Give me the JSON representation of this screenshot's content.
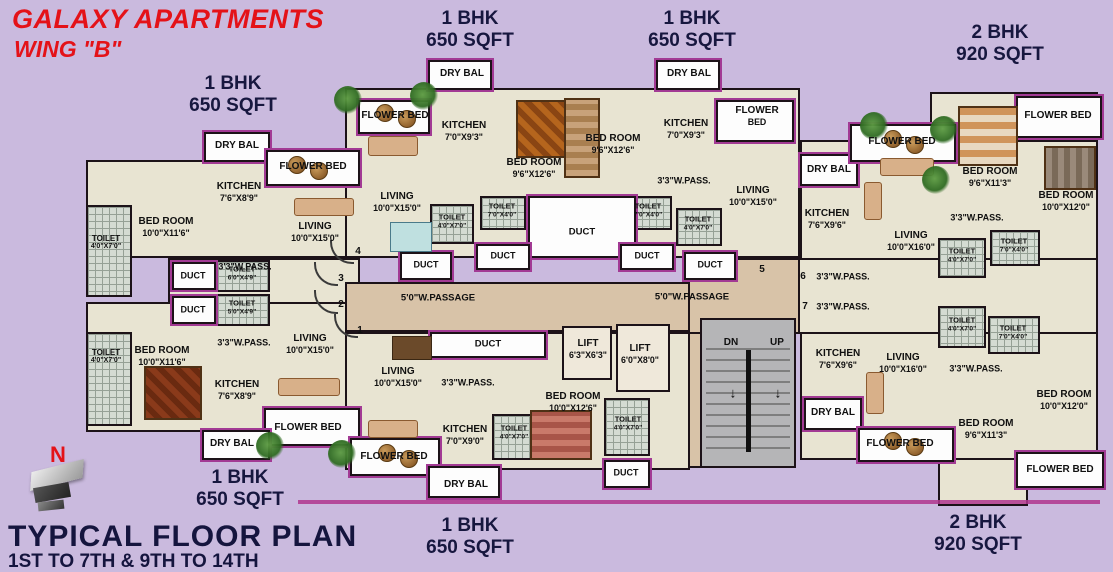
{
  "header": {
    "title": "GALAXY APARTMENTS",
    "wing": "WING \"B\""
  },
  "footer": {
    "north": "N",
    "plan_title": "TYPICAL FLOOR PLAN",
    "floors_range": "1ST TO 7TH & 9TH TO 14TH"
  },
  "colors": {
    "background": "#cabade",
    "room_fill": "#e8e4d2",
    "wall": "#1c1218",
    "balcony_trim": "#a23a94",
    "passage": "#d8c3a8",
    "stair": "#b5b5b7",
    "title_red": "#e41218",
    "navy": "#17173f"
  },
  "unit_labels": [
    {
      "n": "unit-label-1bhk-top-left",
      "l1": "1 BHK",
      "l2": "650 SQFT",
      "x": 233,
      "y": 95
    },
    {
      "n": "unit-label-1bhk-top-center",
      "l1": "1 BHK",
      "l2": "650 SQFT",
      "x": 470,
      "y": 30
    },
    {
      "n": "unit-label-1bhk-top-right",
      "l1": "1 BHK",
      "l2": "650 SQFT",
      "x": 692,
      "y": 30
    },
    {
      "n": "unit-label-2bhk-top-right",
      "l1": "2 BHK",
      "l2": "920 SQFT",
      "x": 1000,
      "y": 44
    },
    {
      "n": "unit-label-1bhk-bottom-left",
      "l1": "1 BHK",
      "l2": "650 SQFT",
      "x": 240,
      "y": 489
    },
    {
      "n": "unit-label-1bhk-bottom-center",
      "l1": "1 BHK",
      "l2": "650 SQFT",
      "x": 470,
      "y": 537
    },
    {
      "n": "unit-label-2bhk-bottom-right",
      "l1": "2 BHK",
      "l2": "920 SQFT",
      "x": 978,
      "y": 534
    }
  ],
  "room_labels": [
    {
      "n": "label-dry-bal-tl",
      "t": "DRY BAL",
      "x": 237,
      "y": 146
    },
    {
      "n": "label-flower-bed-tl",
      "t": "FLOWER BED",
      "x": 313,
      "y": 167
    },
    {
      "n": "label-kitchen-tl",
      "t": "KITCHEN",
      "d": "7'6\"X8'9\"",
      "x": 239,
      "y": 192
    },
    {
      "n": "label-bedroom-tl",
      "t": "BED ROOM",
      "d": "10'0\"X11'6\"",
      "x": 166,
      "y": 227
    },
    {
      "n": "label-toilet-tl",
      "t": "TOILET",
      "d": "4'0\"X7'0\"",
      "x": 106,
      "y": 243,
      "fs": 8
    },
    {
      "n": "label-living-tl",
      "t": "LIVING",
      "d": "10'0\"X15'0\"",
      "x": 315,
      "y": 232
    },
    {
      "n": "label-pass-tl",
      "t": "3'3\"W.PASS.",
      "x": 245,
      "y": 267,
      "fs": 9
    },
    {
      "n": "label-duct-left-1",
      "t": "DUCT",
      "x": 193,
      "y": 276,
      "fs": 9
    },
    {
      "n": "label-toilet-left-1",
      "t": "TOILET",
      "d": "6'0\"X4'9\"",
      "x": 242,
      "y": 274,
      "fs": 7.5
    },
    {
      "n": "label-duct-left-2",
      "t": "DUCT",
      "x": 193,
      "y": 310,
      "fs": 9
    },
    {
      "n": "label-toilet-left-2",
      "t": "TOILET",
      "d": "5'0\"X4'9\"",
      "x": 242,
      "y": 308,
      "fs": 7.5
    },
    {
      "n": "flat-number-4",
      "t": "4",
      "x": 358,
      "y": 252,
      "fs": 10
    },
    {
      "n": "flat-number-3",
      "t": "3",
      "x": 341,
      "y": 279,
      "fs": 10
    },
    {
      "n": "flat-number-2",
      "t": "2",
      "x": 341,
      "y": 305,
      "fs": 10
    },
    {
      "n": "flat-number-1",
      "t": "1",
      "x": 360,
      "y": 331,
      "fs": 10
    },
    {
      "n": "flat-number-5",
      "t": "5",
      "x": 762,
      "y": 270,
      "fs": 10
    },
    {
      "n": "flat-number-6",
      "t": "6",
      "x": 803,
      "y": 277,
      "fs": 10
    },
    {
      "n": "flat-number-7",
      "t": "7",
      "x": 805,
      "y": 307,
      "fs": 10
    },
    {
      "n": "label-toilet-bl",
      "t": "TOILET",
      "d": "4'0\"X7'0\"",
      "x": 106,
      "y": 357,
      "fs": 8
    },
    {
      "n": "label-bedroom-bl",
      "t": "BED ROOM",
      "d": "10'0\"X11'6\"",
      "x": 162,
      "y": 356
    },
    {
      "n": "label-pass-bl",
      "t": "3'3\"W.PASS.",
      "x": 244,
      "y": 343,
      "fs": 9
    },
    {
      "n": "label-kitchen-bl",
      "t": "KITCHEN",
      "d": "7'6\"X8'9\"",
      "x": 237,
      "y": 390
    },
    {
      "n": "label-living-bl",
      "t": "LIVING",
      "d": "10'0\"X15'0\"",
      "x": 310,
      "y": 344
    },
    {
      "n": "label-flower-bed-bl",
      "t": "FLOWER BED",
      "x": 308,
      "y": 428
    },
    {
      "n": "label-dry-bal-bl",
      "t": "DRY BAL",
      "x": 232,
      "y": 444
    },
    {
      "n": "label-dry-bal-ct",
      "t": "DRY BAL",
      "x": 462,
      "y": 74
    },
    {
      "n": "label-flower-bed-ct",
      "t": "FLOWER BED",
      "x": 395,
      "y": 116
    },
    {
      "n": "label-kitchen-ct",
      "t": "KITCHEN",
      "d": "7'0\"X9'3\"",
      "x": 464,
      "y": 131
    },
    {
      "n": "label-bedroom-ct",
      "t": "BED ROOM",
      "d": "9'6\"X12'6\"",
      "x": 534,
      "y": 168
    },
    {
      "n": "label-living-ct",
      "t": "LIVING",
      "d": "10'0\"X15'0\"",
      "x": 397,
      "y": 202
    },
    {
      "n": "label-toilet-ct-1",
      "t": "TOILET",
      "d": "4'0\"X7'0\"",
      "x": 452,
      "y": 222,
      "fs": 7.5
    },
    {
      "n": "label-toilet-ct-2",
      "t": "TOILET",
      "d": "7'0\"X4'0\"",
      "x": 502,
      "y": 211,
      "fs": 7.5
    },
    {
      "n": "label-duct-center-main",
      "t": "DUCT",
      "x": 582,
      "y": 232,
      "fs": 9.5
    },
    {
      "n": "label-dry-bal-crt",
      "t": "DRY BAL",
      "x": 689,
      "y": 74
    },
    {
      "n": "label-bedroom-crt",
      "t": "BED ROOM",
      "d": "9'6\"X12'6\"",
      "x": 613,
      "y": 144
    },
    {
      "n": "label-kitchen-crt",
      "t": "KITCHEN",
      "d": "7'0\"X9'3\"",
      "x": 686,
      "y": 129
    },
    {
      "n": "label-flower-bed-crt",
      "t": "FLOWER",
      "d": "BED",
      "x": 757,
      "y": 116
    },
    {
      "n": "label-pass-crt",
      "t": "3'3\"W.PASS.",
      "x": 684,
      "y": 181,
      "fs": 9
    },
    {
      "n": "label-living-crt",
      "t": "LIVING",
      "d": "10'0\"X15'0\"",
      "x": 753,
      "y": 196
    },
    {
      "n": "label-toilet-crt-1",
      "t": "TOILET",
      "d": "7'0\"X4'0\"",
      "x": 648,
      "y": 211,
      "fs": 7.5
    },
    {
      "n": "label-toilet-crt-2",
      "t": "TOILET",
      "d": "4'0\"X7'0\"",
      "x": 698,
      "y": 224,
      "fs": 7.5
    },
    {
      "n": "label-duct-center-1",
      "t": "DUCT",
      "x": 503,
      "y": 256,
      "fs": 9
    },
    {
      "n": "label-duct-center-2",
      "t": "DUCT",
      "x": 647,
      "y": 256,
      "fs": 9
    },
    {
      "n": "label-duct-center-3",
      "t": "DUCT",
      "x": 426,
      "y": 265,
      "fs": 9
    },
    {
      "n": "label-duct-center-4",
      "t": "DUCT",
      "x": 710,
      "y": 265,
      "fs": 9
    },
    {
      "n": "label-passage-west",
      "t": "5'0\"W.PASSAGE",
      "x": 438,
      "y": 298,
      "fs": 9.5
    },
    {
      "n": "label-passage-east",
      "t": "5'0\"W.PASSAGE",
      "x": 692,
      "y": 297,
      "fs": 9.5
    },
    {
      "n": "label-dry-bal-rt",
      "t": "DRY BAL",
      "x": 829,
      "y": 170
    },
    {
      "n": "label-flower-bed-rt",
      "t": "FLOWER BED",
      "x": 902,
      "y": 142
    },
    {
      "n": "label-flower-bed-rt2",
      "t": "FLOWER BED",
      "x": 1058,
      "y": 116
    },
    {
      "n": "label-kitchen-rt",
      "t": "KITCHEN",
      "d": "7'6\"X9'6\"",
      "x": 827,
      "y": 219
    },
    {
      "n": "label-living-rt",
      "t": "LIVING",
      "d": "10'0\"X16'0\"",
      "x": 911,
      "y": 241
    },
    {
      "n": "label-bedroom-rt1",
      "t": "BED ROOM",
      "d": "9'6\"X11'3\"",
      "x": 990,
      "y": 177
    },
    {
      "n": "label-bedroom-rt2",
      "t": "BED ROOM",
      "d": "10'0\"X12'0\"",
      "x": 1066,
      "y": 201
    },
    {
      "n": "label-pass-rt",
      "t": "3'3\"W.PASS.",
      "x": 977,
      "y": 218,
      "fs": 9
    },
    {
      "n": "label-toilet-rt-1",
      "t": "TOILET",
      "d": "4'0\"X7'0\"",
      "x": 962,
      "y": 256,
      "fs": 7.5
    },
    {
      "n": "label-toilet-rt-2",
      "t": "TOILET",
      "d": "7'0\"X4'0\"",
      "x": 1014,
      "y": 246,
      "fs": 7.5
    },
    {
      "n": "label-pass-6",
      "t": "3'3\"W.PASS.",
      "x": 843,
      "y": 277,
      "fs": 9
    },
    {
      "n": "label-pass-7",
      "t": "3'3\"W.PASS.",
      "x": 843,
      "y": 307,
      "fs": 9
    },
    {
      "n": "label-lift-1",
      "t": "LIFT",
      "d": "6'3\"X6'3\"",
      "x": 588,
      "y": 349
    },
    {
      "n": "label-lift-2",
      "t": "LIFT",
      "d": "6'0\"X8'0\"",
      "x": 640,
      "y": 354
    },
    {
      "n": "label-stairs-dn",
      "t": "DN",
      "x": 731,
      "y": 343,
      "fs": 10
    },
    {
      "n": "label-stairs-up",
      "t": "UP",
      "x": 777,
      "y": 343,
      "fs": 10
    },
    {
      "n": "stairs-arrow-dn-icon",
      "t": "↓",
      "x": 733,
      "y": 393,
      "fs": 14
    },
    {
      "n": "stairs-arrow-up-icon",
      "t": "↓",
      "x": 778,
      "y": 393,
      "fs": 14
    },
    {
      "n": "label-toilet-stair",
      "t": "TOILET",
      "d": "4'0\"X7'0\"",
      "x": 628,
      "y": 424,
      "fs": 7.5
    },
    {
      "n": "label-duct-stair",
      "t": "DUCT",
      "x": 626,
      "y": 473,
      "fs": 9
    },
    {
      "n": "label-duct-bc",
      "t": "DUCT",
      "x": 488,
      "y": 344,
      "fs": 9.5
    },
    {
      "n": "label-living-bc",
      "t": "LIVING",
      "d": "10'0\"X15'0\"",
      "x": 398,
      "y": 377
    },
    {
      "n": "label-pass-bc",
      "t": "3'3\"W.PASS.",
      "x": 468,
      "y": 383,
      "fs": 9
    },
    {
      "n": "label-kitchen-bc",
      "t": "KITCHEN",
      "d": "7'0\"X9'0\"",
      "x": 465,
      "y": 435
    },
    {
      "n": "label-toilet-bc",
      "t": "TOILET",
      "d": "4'0\"X7'0\"",
      "x": 514,
      "y": 433,
      "fs": 7.5
    },
    {
      "n": "label-bedroom-bc",
      "t": "BED ROOM",
      "d": "10'0\"X12'6\"",
      "x": 573,
      "y": 402
    },
    {
      "n": "label-flower-bed-bc",
      "t": "FLOWER BED",
      "x": 394,
      "y": 457
    },
    {
      "n": "label-dry-bal-bc",
      "t": "DRY BAL",
      "x": 466,
      "y": 485
    },
    {
      "n": "label-kitchen-rb",
      "t": "KITCHEN",
      "d": "7'6\"X9'6\"",
      "x": 838,
      "y": 359
    },
    {
      "n": "label-dry-bal-rb",
      "t": "DRY BAL",
      "x": 833,
      "y": 413
    },
    {
      "n": "label-living-rb",
      "t": "LIVING",
      "d": "10'0\"X16'0\"",
      "x": 903,
      "y": 363
    },
    {
      "n": "label-pass-rb",
      "t": "3'3\"W.PASS.",
      "x": 976,
      "y": 369,
      "fs": 9
    },
    {
      "n": "label-toilet-rb-1",
      "t": "TOILET",
      "d": "4'0\"X7'0\"",
      "x": 962,
      "y": 325,
      "fs": 7.5
    },
    {
      "n": "label-toilet-rb-2",
      "t": "TOILET",
      "d": "7'0\"X4'0\"",
      "x": 1013,
      "y": 333,
      "fs": 7.5
    },
    {
      "n": "label-bedroom-rb1",
      "t": "BED ROOM",
      "d": "9'6\"X11'3\"",
      "x": 986,
      "y": 429
    },
    {
      "n": "label-bedroom-rb2",
      "t": "BED ROOM",
      "d": "10'0\"X12'0\"",
      "x": 1064,
      "y": 400
    },
    {
      "n": "label-flower-bed-rb1",
      "t": "FLOWER BED",
      "x": 900,
      "y": 444
    },
    {
      "n": "label-flower-bed-rb2",
      "t": "FLOWER BED",
      "x": 1060,
      "y": 470
    }
  ]
}
